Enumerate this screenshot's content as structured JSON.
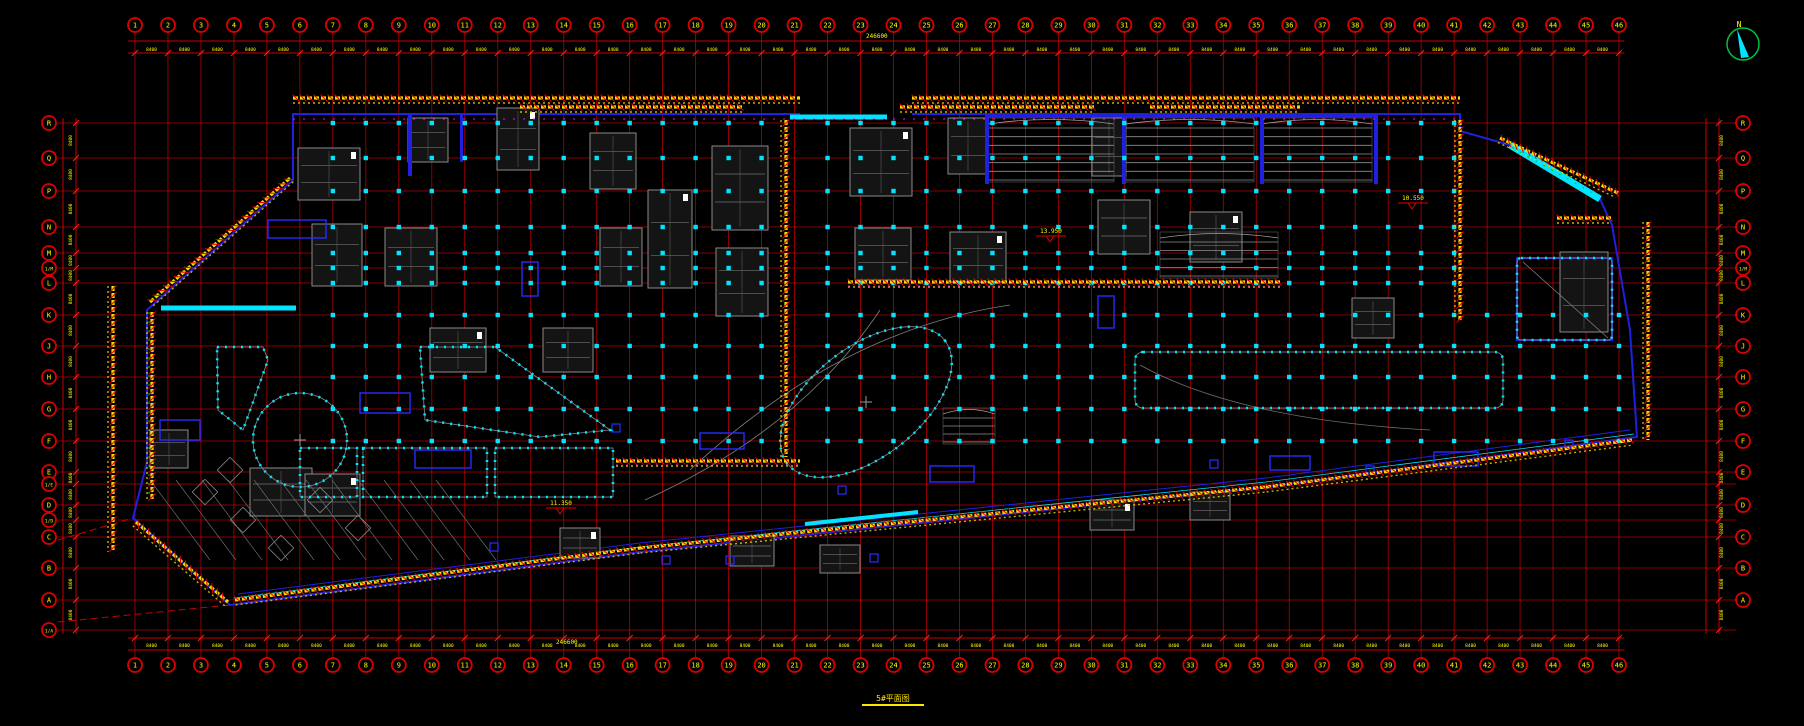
{
  "title": {
    "text": "5#平面图"
  },
  "compass": {
    "label": "N"
  },
  "grid": {
    "column_labels": [
      "1",
      "2",
      "3",
      "4",
      "5",
      "6",
      "7",
      "8",
      "9",
      "10",
      "11",
      "12",
      "13",
      "14",
      "15",
      "16",
      "17",
      "18",
      "19",
      "20",
      "21",
      "22",
      "23",
      "24",
      "25",
      "26",
      "27",
      "28",
      "29",
      "30",
      "31",
      "32",
      "33",
      "34",
      "35",
      "36",
      "37",
      "38",
      "39",
      "40",
      "41",
      "42",
      "43",
      "44",
      "45",
      "46"
    ],
    "left_row_labels": [
      "R",
      "Q",
      "P",
      "N",
      "M",
      "1/M",
      "L",
      "K",
      "J",
      "H",
      "G",
      "F",
      "E",
      "1/E",
      "D",
      "1/D",
      "C",
      "B",
      "A",
      "1/A"
    ],
    "right_row_labels": [
      "R",
      "Q",
      "P",
      "N",
      "M",
      "1/M",
      "L",
      "K",
      "J",
      "H",
      "G",
      "F",
      "E",
      "D",
      "C",
      "B",
      "A"
    ],
    "bay_dimension": "8400",
    "top_total_dimension": "246600",
    "bottom_total_dimension": "246600"
  },
  "levels": [
    {
      "value": "13.950"
    },
    {
      "value": "10.550"
    },
    {
      "value": "11.350"
    }
  ],
  "colors": {
    "background": "#000000",
    "grid_line": "#c80000",
    "bubble_line": "#dc0000",
    "dimension_text": "#ffff00",
    "wall_blue": "#2020e0",
    "glass_cyan": "#00e5ff",
    "detail_gray": "#8a8a8a",
    "accent_magenta": "#ff00ff",
    "accent_green": "#00bb00",
    "compass_green": "#00c040"
  }
}
